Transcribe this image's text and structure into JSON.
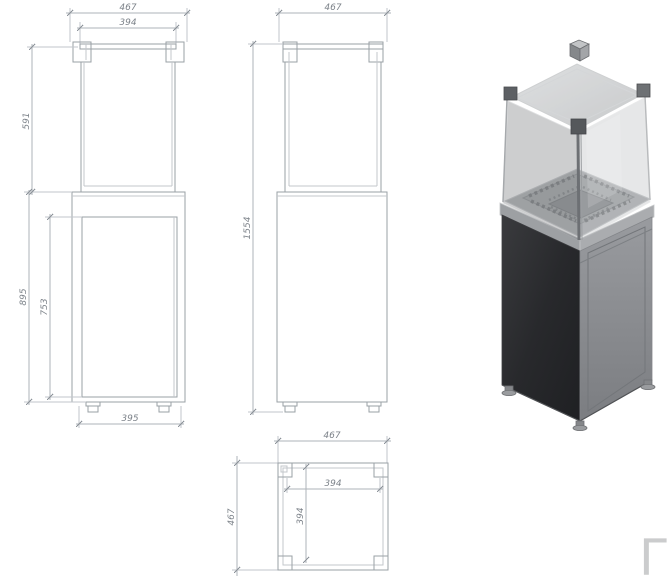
{
  "drawing_title": "patio-gas-heater-technical-drawing",
  "views": {
    "front": {
      "dim_overall_width": "467",
      "dim_glass_width": "394",
      "dim_glass_height": "591",
      "dim_base_height": "895",
      "dim_door_height": "753",
      "dim_feet_spacing": "395"
    },
    "side": {
      "dim_overall_width": "467",
      "dim_total_height": "1554"
    },
    "plan": {
      "dim_overall_width": "467",
      "dim_overall_depth": "467",
      "dim_inner_width": "394",
      "dim_inner_depth": "394"
    }
  },
  "watermark": {
    "text": "Γ"
  },
  "colors": {
    "object_line": "#9aa0a6",
    "dimension_text": "#7d838a",
    "pedestal_dark_face": "#2c2d30",
    "pedestal_light_face": "#909396",
    "glass": "#c7cacc",
    "watermark_gray": "#cbcccd"
  }
}
